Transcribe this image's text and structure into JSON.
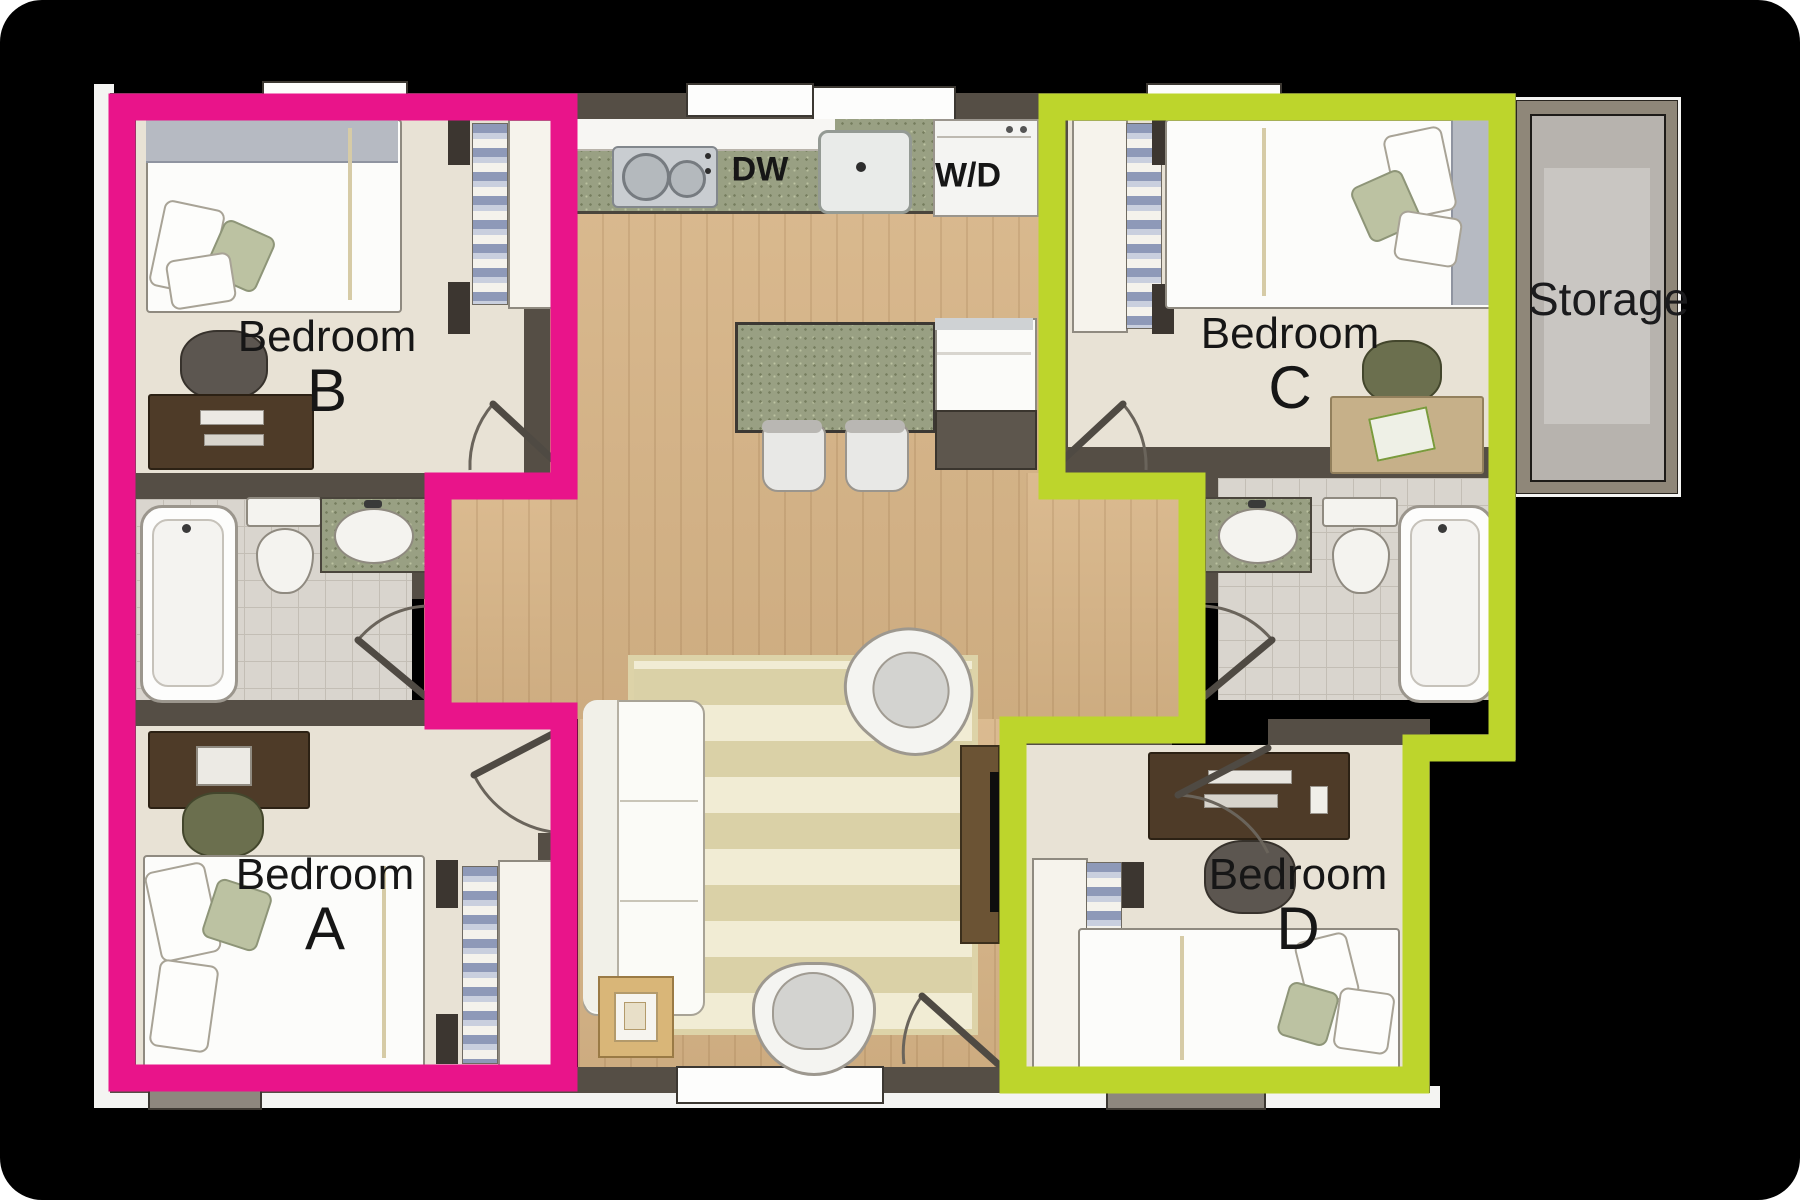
{
  "plan": {
    "rooms": {
      "bedroom_b": {
        "name": "Bedroom",
        "letter": "B"
      },
      "bedroom_a": {
        "name": "Bedroom",
        "letter": "A"
      },
      "bedroom_c": {
        "name": "Bedroom",
        "letter": "C"
      },
      "bedroom_d": {
        "name": "Bedroom",
        "letter": "D"
      },
      "storage": {
        "name": "Storage"
      }
    },
    "labels": {
      "dishwasher": "DW",
      "washer_dryer": "W/D"
    },
    "colors": {
      "left_suite_outline": "#e9148a",
      "right_suite_outline": "#bdd52c",
      "walls": "#554e45",
      "wood_floor": "#d8b587",
      "bedroom_floor": "#e8e2d5",
      "tile_floor": "#d9d5ce",
      "granite_counter": "#99a083"
    }
  }
}
